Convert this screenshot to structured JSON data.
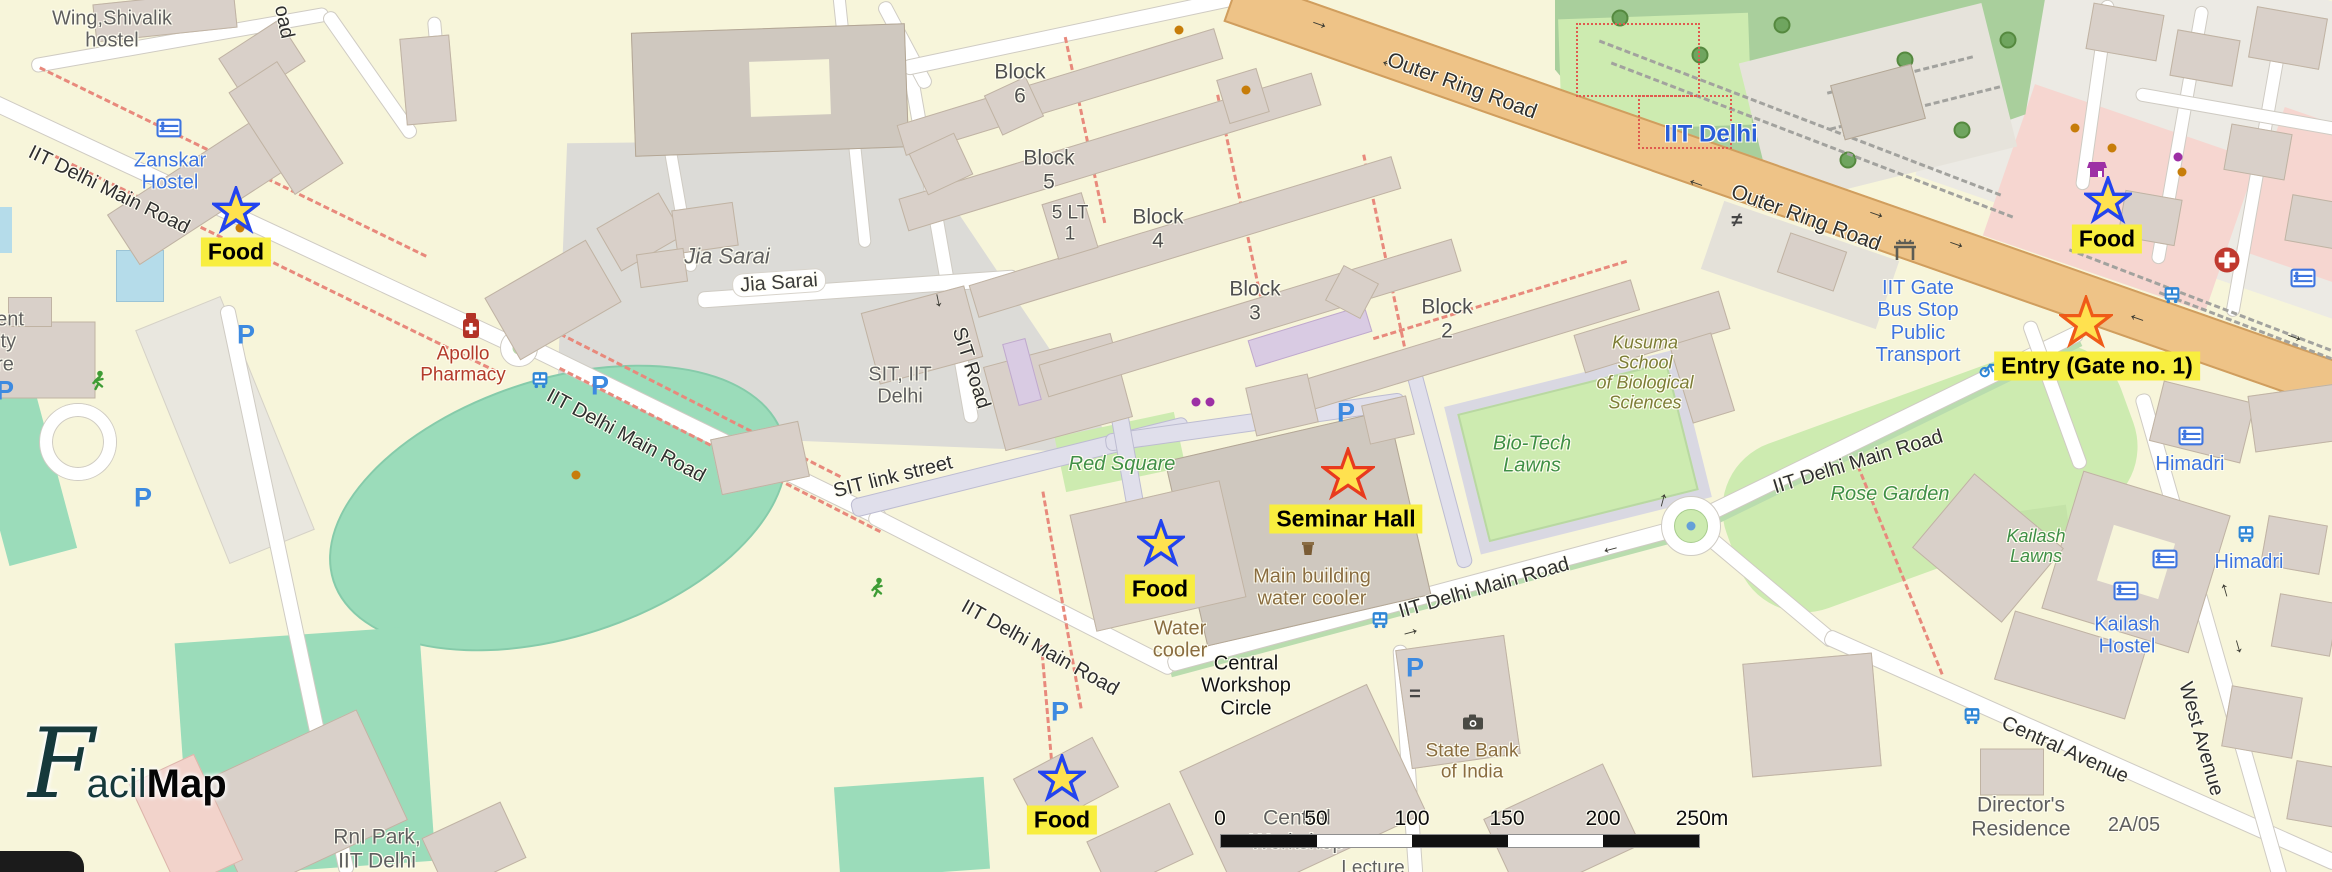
{
  "app": {
    "logo_script": "F",
    "logo_mid": "acil",
    "logo_bold": "Map"
  },
  "colors": {
    "campus_bg": "#f7f5da",
    "outside_bg": "#eceae4",
    "building": "#d9d0c9",
    "trunk_road": "#eec387",
    "forest": "#a9cf9c",
    "lawn": "#cdebb0",
    "pitch": "#9bdcba",
    "residential_area": "#dcdbd7",
    "retail_pink": "#f6d6d0",
    "marker_label_bg": "#f8ee3f",
    "star_fill": "#ffe14f",
    "food_star_stroke": "#2344ee",
    "seminar_star_stroke": "#e83a1e",
    "entry_star_stroke": "#ef5a18",
    "hostel_blue": "#3d74e0",
    "nature_green": "#3f8f46",
    "amenity_brown": "#8a6d40",
    "pharmacy_red": "#b33a2a",
    "dashed_path_red": "#e8897c"
  },
  "markers": [
    {
      "label": "Food",
      "type": "food"
    },
    {
      "label": "Food",
      "type": "food"
    },
    {
      "label": "Food",
      "type": "food"
    },
    {
      "label": "Food",
      "type": "food"
    },
    {
      "label": "Seminar Hall",
      "type": "destination"
    },
    {
      "label": "Entry (Gate no. 1)",
      "type": "entry"
    }
  ],
  "labels": [
    {
      "text": "Wing,Shivalik\nhostel"
    },
    {
      "text": "Zanskar\nHostel"
    },
    {
      "text": "IIT Delhi Main Road"
    },
    {
      "text": "Jia Sarai"
    },
    {
      "text": "Jia Sarai"
    },
    {
      "text": "SIT, IIT\nDelhi"
    },
    {
      "text": "SIT Road"
    },
    {
      "text": "SIT link street"
    },
    {
      "text": "Block\n6"
    },
    {
      "text": "Block\n5"
    },
    {
      "text": "5 LT\n1"
    },
    {
      "text": "Block\n4"
    },
    {
      "text": "Block\n3"
    },
    {
      "text": "Block\n2"
    },
    {
      "text": "IIT Delhi Main Road"
    },
    {
      "text": "IIT Delhi Main Road"
    },
    {
      "text": "IIT Delhi Main Road"
    },
    {
      "text": "IIT Delhi Main Road"
    },
    {
      "text": "Outer Ring Road"
    },
    {
      "text": "Outer Ring Road"
    },
    {
      "text": "Red Square"
    },
    {
      "text": "Kusuma\nSchool\nof Biological\nSciences"
    },
    {
      "text": "Bio-Tech\nLawns"
    },
    {
      "text": "Main building\nwater cooler"
    },
    {
      "text": "Water\ncooler"
    },
    {
      "text": "Central\nWorkshop\nCircle"
    },
    {
      "text": "State Bank\nof India"
    },
    {
      "text": "Central\nWorkshop"
    },
    {
      "text": "Lecture"
    },
    {
      "text": "RnI Park,\nIIT Delhi"
    },
    {
      "text": "IIT Delhi"
    },
    {
      "text": "IIT Gate\nBus Stop\nPublic\nTransport"
    },
    {
      "text": "Himadri"
    },
    {
      "text": "Himadri"
    },
    {
      "text": "Kailash\nHostel"
    },
    {
      "text": "Kailash\nLawns"
    },
    {
      "text": "Rose Garden"
    },
    {
      "text": "Central Avenue"
    },
    {
      "text": "West Avenue"
    },
    {
      "text": "Director's\nResidence"
    },
    {
      "text": "2A/05"
    },
    {
      "text": "Apollo\nPharmacy"
    },
    {
      "text": "ent\nity\nre"
    },
    {
      "text": "oad"
    }
  ],
  "scale": {
    "ticks": [
      "0",
      "50",
      "100",
      "150",
      "200",
      "250m"
    ]
  },
  "glyphs": {
    "parking": "P",
    "arrow_right": "→",
    "arrow_left": "←",
    "arrow_up": "↑",
    "arrow_down": "↓",
    "barrier": "≠",
    "equals": "="
  }
}
